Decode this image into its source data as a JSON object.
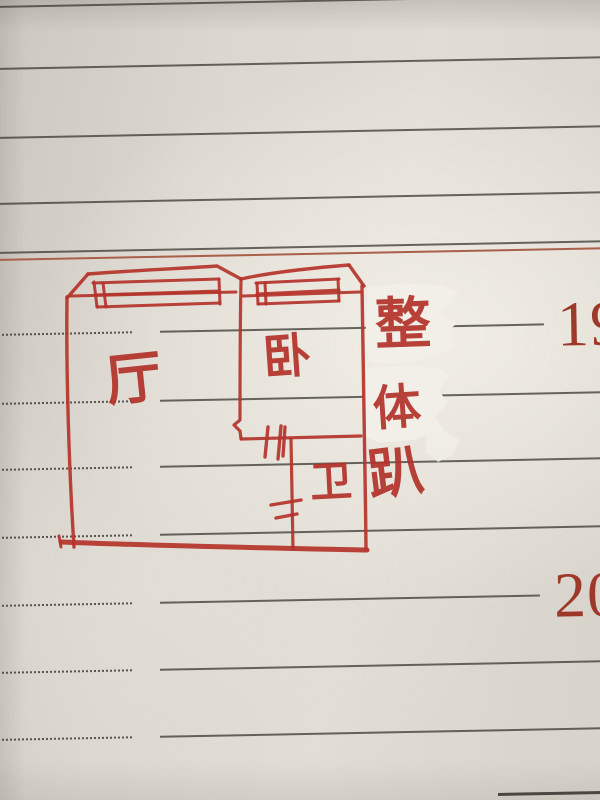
{
  "paper": {
    "base_color": "#d9d5cd",
    "rule_line_color": "#403d37",
    "red_rule_color": "#a8604a",
    "ink_color": "#b2322a",
    "number_color": "#9e392a",
    "tape_color": "#f2efe9"
  },
  "margin": {
    "numbers": [
      "19",
      "20"
    ]
  },
  "floor_plan": {
    "rooms": [
      {
        "id": "hall",
        "label": "厅"
      },
      {
        "id": "bedroom",
        "label": "卧"
      },
      {
        "id": "bathroom",
        "label": "卫"
      }
    ]
  },
  "annotation": {
    "text": "整体趴",
    "chars": [
      "整",
      "体",
      "趴"
    ]
  }
}
